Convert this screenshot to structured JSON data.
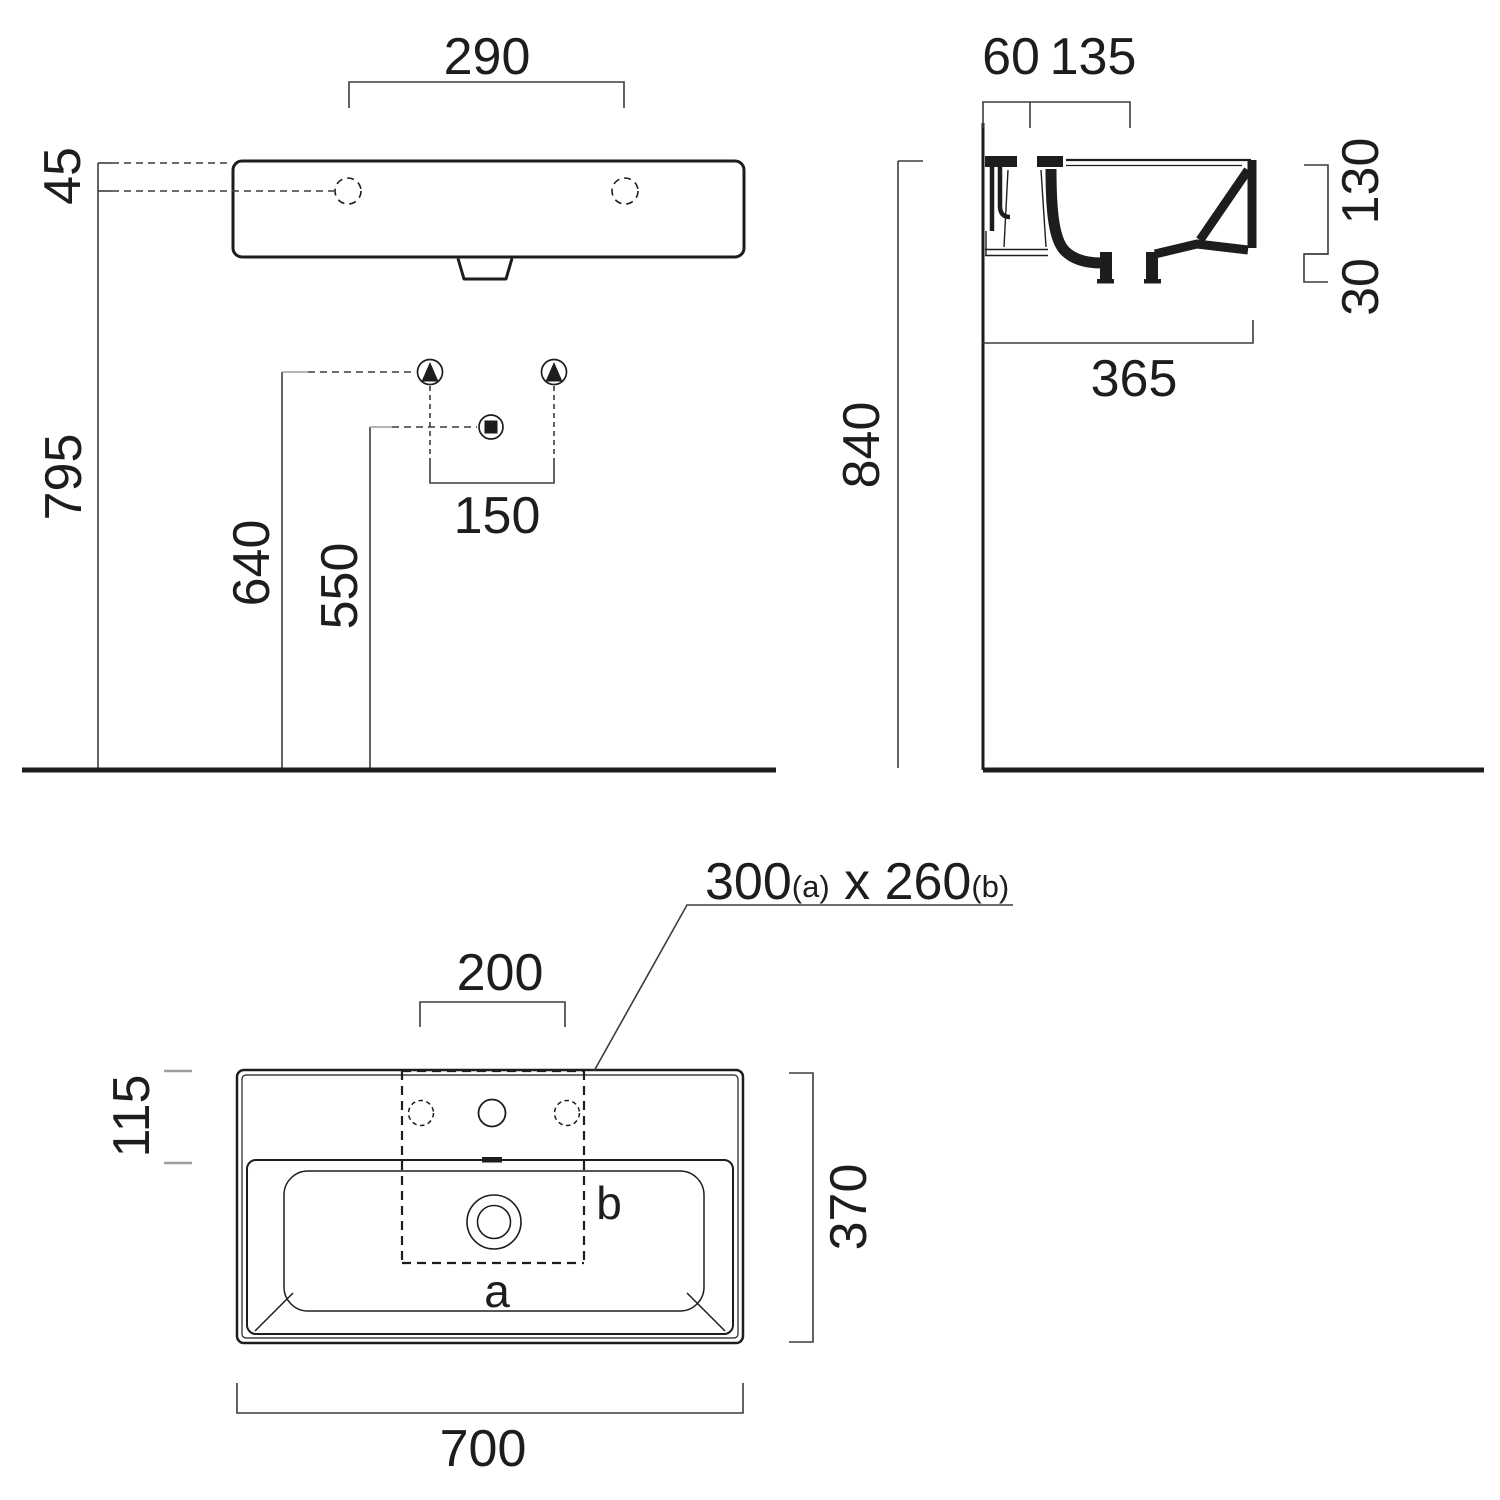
{
  "drawing_type": "washbasin technical dimension drawing",
  "front_view": {
    "dim_hole_span": "290",
    "dim_rim_to_hole": "45",
    "dim_height_rim": "795",
    "dim_height_supply": "640",
    "dim_height_drain": "550",
    "dim_supply_span": "150"
  },
  "side_view": {
    "dim_wall_to_hole": "60",
    "dim_hole_to_edge": "135",
    "dim_basin_depth": "130",
    "dim_apron": "30",
    "dim_total_depth": "365",
    "dim_mount_height": "840"
  },
  "plan_view": {
    "dim_hole_spacing": "200",
    "dim_back_deck": "115",
    "dim_overall_depth": "370",
    "dim_overall_width": "700",
    "cutout_note": {
      "v1": "300",
      "s1": "(a)",
      "x": " x ",
      "v2": "260",
      "s2": "(b)"
    },
    "label_a": "a",
    "label_b": "b"
  },
  "colors": {
    "line": "#1d1d1b",
    "dimension": "#3c3c3b",
    "light_tick": "#9d9d9c",
    "background": "#ffffff"
  }
}
